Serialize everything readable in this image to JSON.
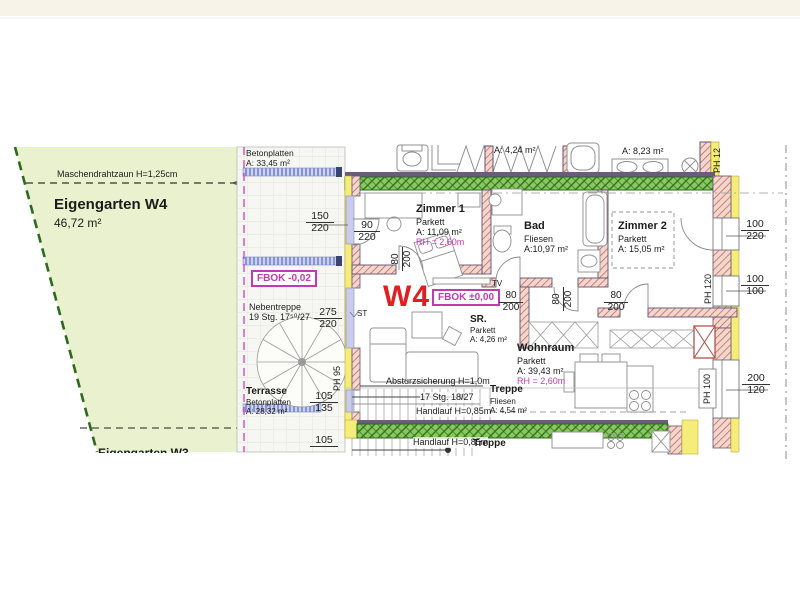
{
  "title": {
    "unit": "W4"
  },
  "garden": {
    "fence_label": "Maschendrahtzaun H=1,25cm",
    "name": "Eigengarten W4",
    "area": "46,72 m²",
    "neighbor_partial": "Eigengarten W3"
  },
  "terrace_upper": {
    "material": "Betonplatten",
    "area": "A: 33,45 m²"
  },
  "terrace": {
    "name": "Terrasse",
    "material": "Betonplatten",
    "area": "A: 28,32 m²"
  },
  "levels": {
    "fbok_terrace": "FBOK -0,02",
    "fbok_unit": "FBOK ±0,00"
  },
  "spiral_stair": {
    "name": "Nebentreppe",
    "steps": "19 Stg. 17⁵⁰/27"
  },
  "rooms": {
    "zimmer1": {
      "name": "Zimmer 1",
      "floor": "Parkett",
      "area": "A: 11,09 m²",
      "height": "RH = 2,60m"
    },
    "bad": {
      "name": "Bad",
      "floor": "Fliesen",
      "area": "A:10,97 m²"
    },
    "zimmer2": {
      "name": "Zimmer 2",
      "floor": "Parkett",
      "area": "A: 15,05 m²"
    },
    "sr": {
      "name": "SR.",
      "floor": "Parkett",
      "area": "A: 4,26 m²"
    },
    "wohnraum": {
      "name": "Wohnraum",
      "floor": "Parkett",
      "area": "A: 39,43 m²",
      "height": "RH = 2,60m"
    },
    "treppe": {
      "name": "Treppe",
      "floor": "Fliesen",
      "area": "A: 4,54 m²"
    },
    "upper_hall": {
      "area": "A: 4,24 m²"
    },
    "upper_bath": {
      "area": "A: 8,23 m²"
    }
  },
  "stairs": {
    "main": "17 Stg. 18/27",
    "handrail": "Handlauf H=0,85m",
    "guard": "Absturzsicherung H=1,0m",
    "lower_handrail": "Handlauf H=0,85m",
    "lower_name": "Treppe"
  },
  "misc": {
    "st": "ST",
    "tv": "TV"
  },
  "dims": {
    "win_west": {
      "w": "150",
      "h": "220"
    },
    "door_zimmer1_west": {
      "w": "90",
      "h": "220"
    },
    "door_interior": {
      "w": "80",
      "h": "200"
    },
    "spiral": {
      "w": "275",
      "h": "220"
    },
    "terrace_step": {
      "w": "105",
      "h": "135"
    },
    "terrace_step_lower": "105",
    "win_east_1": {
      "w": "100",
      "h": "220"
    },
    "win_east_2": {
      "w": "100",
      "h": "100"
    },
    "win_east_3": {
      "w": "200",
      "h": "120"
    },
    "ph_120": "PH 120",
    "ph_100": "PH 100",
    "ph_95": "PH 95",
    "ph_12": "PH 12"
  },
  "colors": {
    "wall_hatch": "#c4685a",
    "insulation": "#f6ec7a",
    "green_wall": "#3f8a2a",
    "garden": "#e9f1ce",
    "magenta": "#c23ab0",
    "unit_red": "#e02020"
  }
}
